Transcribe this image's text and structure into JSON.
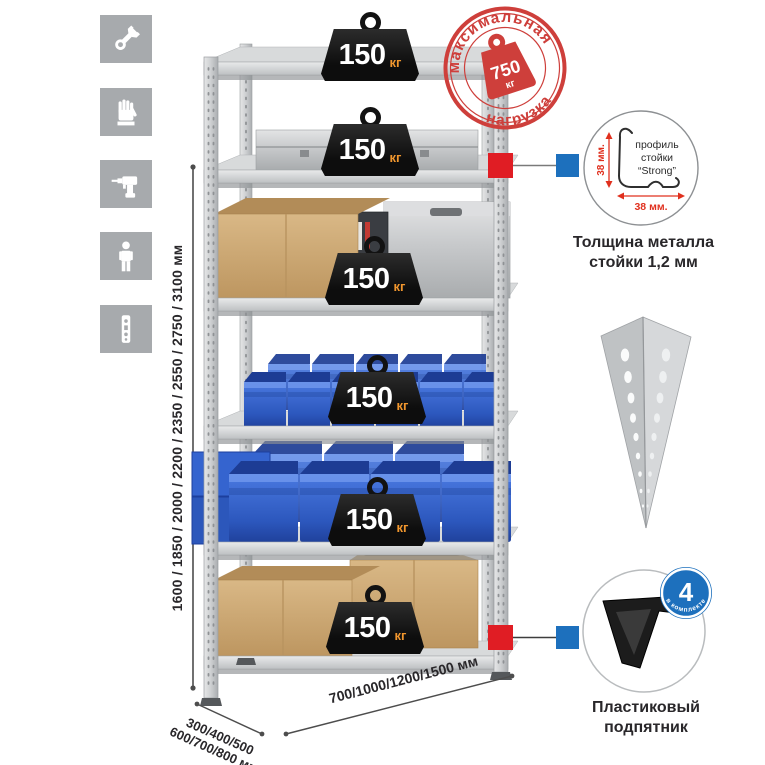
{
  "colors": {
    "stamp_red": "#ce3f3b",
    "marker_red": "#e01d24",
    "marker_blue": "#1d70bd",
    "bin_blue": "#2e5ec6",
    "badge_unit_orange": "#f0962e",
    "tile_gray": "#a7aaad",
    "metal_gray": "#c9cbcd"
  },
  "sidebar": {
    "icons": [
      "wrench-icon",
      "gloves-icon",
      "drill-icon",
      "person-icon",
      "perforated-profile-icon"
    ]
  },
  "dimensions": {
    "height_label": "1600 / 1850 / 2000 / 2200 / 2350 / 2550 / 2750 / 3100 мм",
    "depth_label_line1": "300/400/500",
    "depth_label_line2": "600/700/800 мм",
    "width_label": "700/1000/1200/1500 мм"
  },
  "rack": {
    "badges": [
      {
        "value": "150",
        "unit": "кг"
      },
      {
        "value": "150",
        "unit": "кг"
      },
      {
        "value": "150",
        "unit": "кг"
      },
      {
        "value": "150",
        "unit": "кг"
      },
      {
        "value": "150",
        "unit": "кг"
      },
      {
        "value": "150",
        "unit": "кг"
      }
    ]
  },
  "stamp": {
    "arc_top": "максимальная",
    "arc_bottom": "нагрузка",
    "weight_value": "750",
    "weight_unit": "кг"
  },
  "profile_detail": {
    "line1": "профиль",
    "line2": "стойки",
    "line3": "“Strong”",
    "dim_vertical": "38 мм.",
    "dim_horizontal": "38 мм.",
    "caption_line1": "Толщина металла",
    "caption_line2": "стойки 1,2 мм"
  },
  "foot_detail": {
    "badge_count": "4",
    "badge_arc": "в комплекте",
    "caption_line1": "Пластиковый",
    "caption_line2": "подпятник"
  }
}
